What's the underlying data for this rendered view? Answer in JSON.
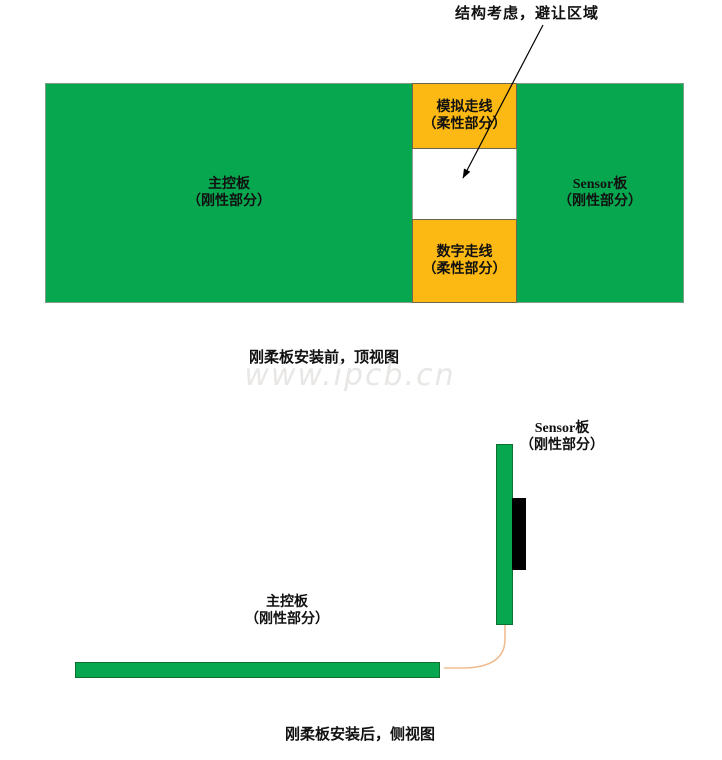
{
  "colors": {
    "board_green": "#07a750",
    "bar_border_green": "#0d7031",
    "flex_orange": "#fcb813",
    "component_black": "#000000",
    "flex_cable_peach": "#f0bd92",
    "watermark_gray": "#e9e7e5"
  },
  "annotation": {
    "label": "结构考虑，避让区域"
  },
  "top_view": {
    "main_board": {
      "name": "主控板",
      "part": "（刚性部分）"
    },
    "analog_flex": {
      "name": "模拟走线",
      "part": "（柔性部分）"
    },
    "digital_flex": {
      "name": "数字走线",
      "part": "（柔性部分）"
    },
    "sensor_board": {
      "name": "Sensor板",
      "part": "（刚性部分）"
    },
    "caption": "刚柔板安装前，顶视图"
  },
  "watermark": {
    "text": "www.ipcb.cn"
  },
  "side_view": {
    "sensor_board": {
      "name": "Sensor板",
      "part": "（刚性部分）"
    },
    "main_board": {
      "name": "主控板",
      "part": "（刚性部分）"
    },
    "caption": "刚柔板安装后，侧视图"
  }
}
